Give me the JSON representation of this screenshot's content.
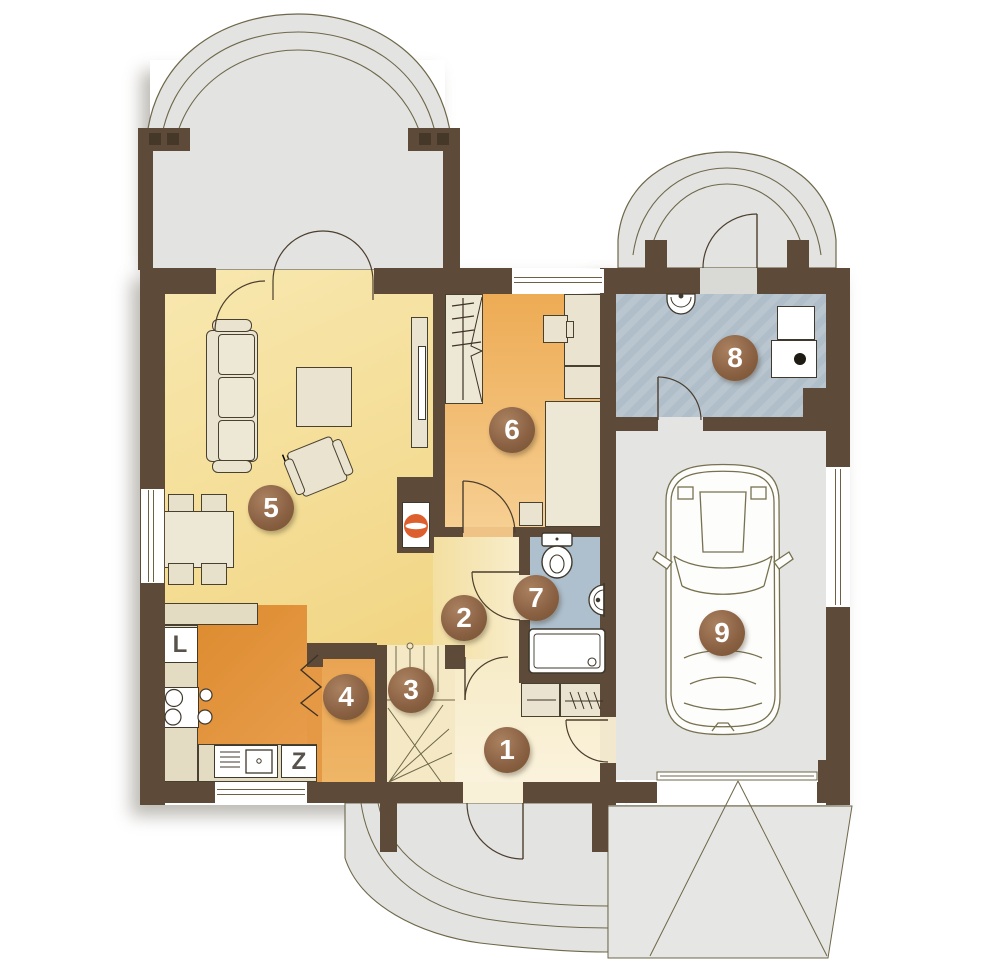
{
  "plan": {
    "rooms": [
      {
        "number": "1"
      },
      {
        "number": "2"
      },
      {
        "number": "3"
      },
      {
        "number": "4"
      },
      {
        "number": "5"
      },
      {
        "number": "6"
      },
      {
        "number": "7"
      },
      {
        "number": "8"
      },
      {
        "number": "9"
      }
    ],
    "appliances": {
      "fridge": "L",
      "dishwasher": "Z"
    },
    "colors": {
      "wall": "#5D4A39",
      "living_floor": "#F1D583",
      "bedroom_floor": "#EDAB54",
      "kitchen_floor": "#DE8D31",
      "hall_floor": "#F7ECC8",
      "stairs_floor": "#F5E9C5",
      "bathroom_floor": "#AEC0CE",
      "utility_floor": "#B7C4CE",
      "garage_floor": "#E4E4E2",
      "terrace": "#E3E3E2",
      "marker": "#8B6244",
      "fireplace_fire": "#DE5F2E",
      "outline": "#6E6749"
    }
  }
}
